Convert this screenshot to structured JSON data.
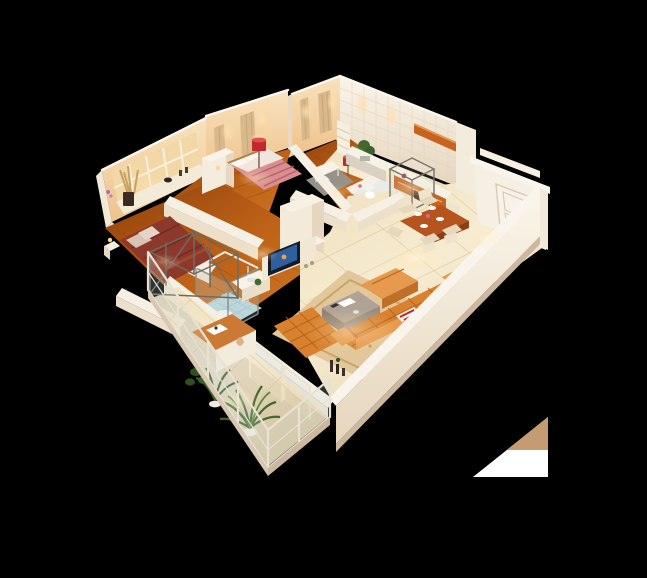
{
  "meta": {
    "type": "3d-isometric-floor-plan-render",
    "description": "Photorealistic 3D cutaway floor plan of a furnished apartment seen from above at an angle, isolated on a black background",
    "canvas": {
      "width": 647,
      "height": 578
    },
    "background": "#000000"
  },
  "palette": {
    "wall_white": "#f6f0e4",
    "wall_face": "#f0e5d2",
    "wall_shadow": "#e2d0b8",
    "wall_peach": "#f6d5a9",
    "wood_floor": "#b4571a",
    "tile_floor": "#f3e4c2",
    "balcony_tile": "#ece2cf",
    "mosaic_blue": "#b9d6d8",
    "orange_sofa": "#d9812f",
    "orange_sofa_light": "#e59a4d",
    "orange_cabinet": "#c8621f",
    "dining_table": "#b5541e",
    "bed_maroon": "#8c392b",
    "bed_pink": "#d98f92",
    "lamp_red": "#c1272d",
    "plant_green": "#42682e",
    "plant_dark": "#2e5020",
    "glass": "#cfe0e0",
    "tv_screen": "#2e5f9e",
    "chair_cream": "#efe3cd",
    "table_taupe": "#b0a296",
    "artifact_tan": "#c59c72",
    "artifact_white": "#ffffff"
  },
  "rooms": [
    {
      "id": "master-bedroom",
      "label": "Master bedroom",
      "floor": "wood",
      "furniture": [
        "double bed with pink and maroon bedding",
        "white wardrobe",
        "wall curtains",
        "red drum lamp"
      ]
    },
    {
      "id": "second-bedroom",
      "label": "Second bedroom",
      "floor": "wood",
      "furniture": [
        "double bed with maroon bedding",
        "bedside table",
        "window wall with pampas vase"
      ]
    },
    {
      "id": "study",
      "label": "Study",
      "floor": "wood",
      "furniture": [
        "white desk and chair",
        "ladder bookshelf",
        "red drum lamp",
        "potted plant",
        "sideboard",
        "grey rug"
      ]
    },
    {
      "id": "bathroom",
      "label": "Bathroom",
      "floor": "blue mosaic",
      "furniture": [
        "glass shower cabin",
        "white vanity"
      ]
    },
    {
      "id": "wc",
      "label": "WC",
      "floor": "tile",
      "furniture": [
        "toilet"
      ]
    },
    {
      "id": "kitchen",
      "label": "Kitchen",
      "floor": "tile",
      "furniture": [
        "orange wall shelf",
        "orange base cabinets with white counter",
        "sink counter",
        "glass partition cube",
        "tiled walls with arched light niches"
      ]
    },
    {
      "id": "dining-area",
      "label": "Dining area",
      "floor": "cream tile",
      "furniture": [
        "orange wood dining table",
        "six cream upholstered chairs",
        "white tableware",
        "pink flowers"
      ]
    },
    {
      "id": "living-room",
      "label": "Living room",
      "floor": "cream tile",
      "furniture": [
        "orange L-shaped tufted sofa",
        "orange tufted daybed",
        "orange chaise",
        "taupe coffee table",
        "patterned beige rug",
        "TV partition wall with flat-screen TV",
        "red striped pillow"
      ]
    },
    {
      "id": "entry",
      "label": "Entry",
      "floor": "cream tile",
      "furniture": [
        "white panelled entry door",
        "white shoe cabinet"
      ]
    },
    {
      "id": "balcony",
      "label": "Balcony",
      "floor": "tile",
      "furniture": [
        "glass railing with cream frame",
        "dark metal frame structure",
        "two potted palms",
        "orange console table with decor"
      ]
    }
  ],
  "artifact": {
    "description": "white and tan triangular fragment",
    "position": "bottom-right corner"
  }
}
